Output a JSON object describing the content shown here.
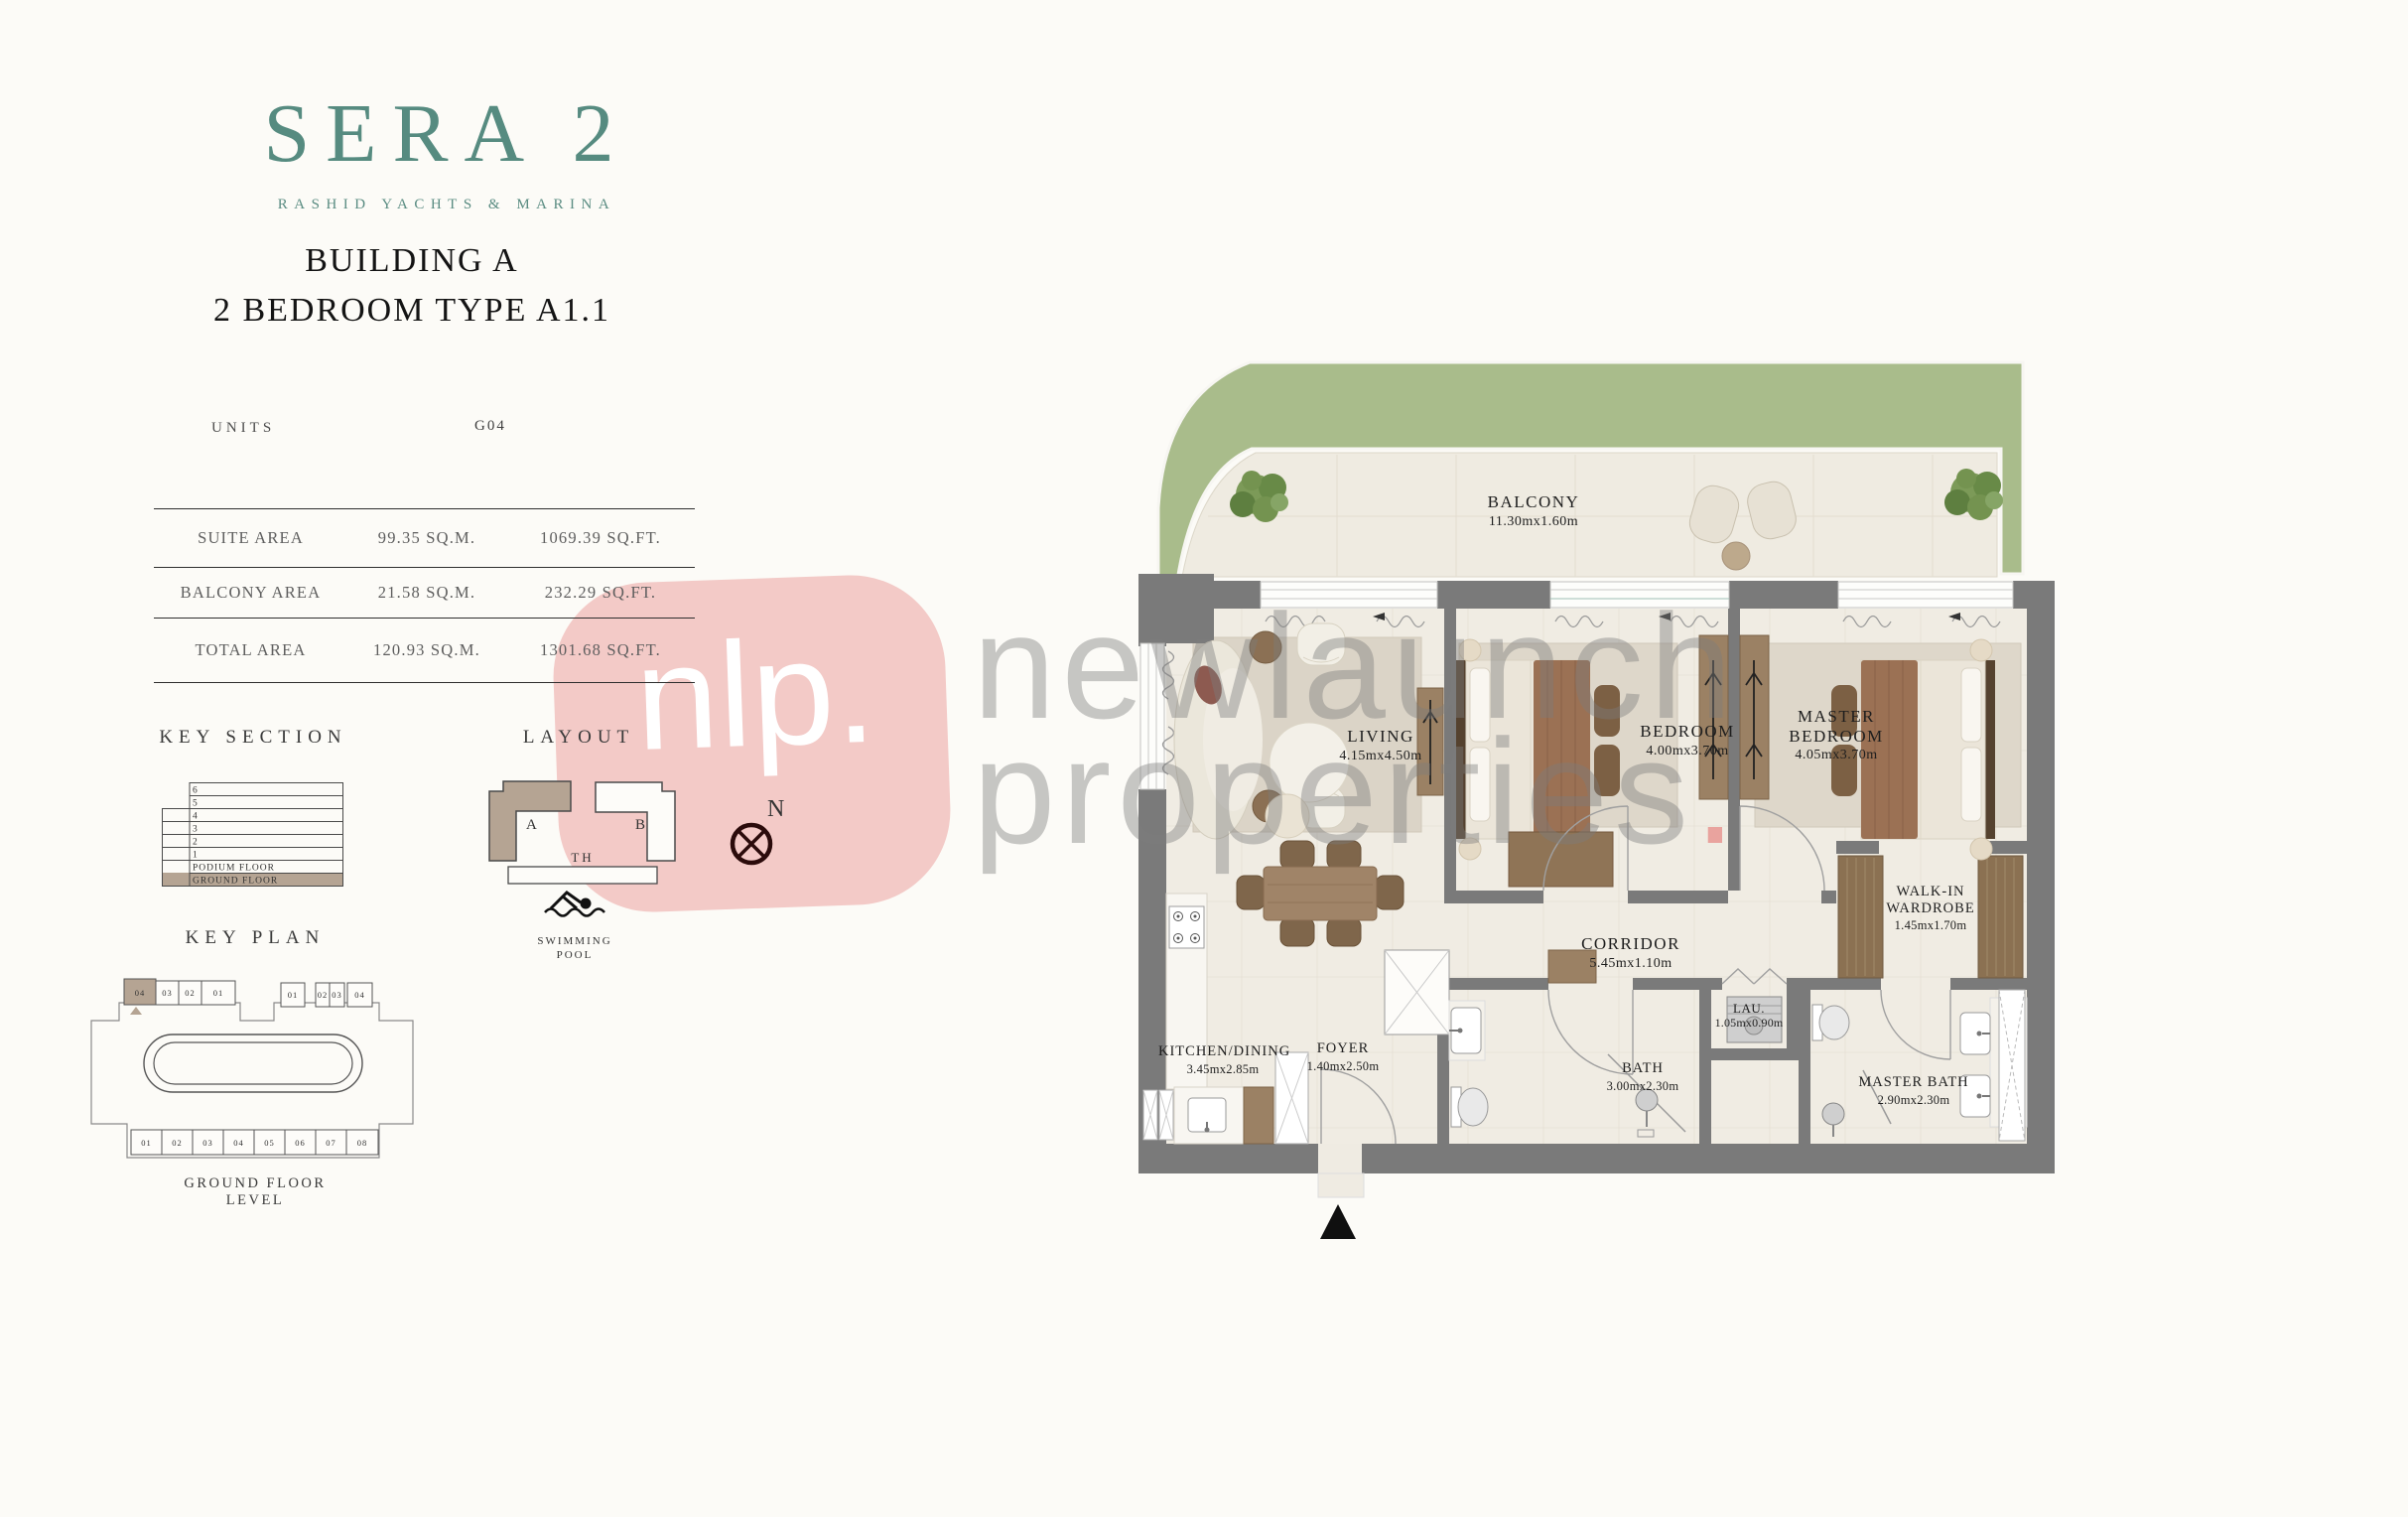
{
  "logo": {
    "title": "SERA 2",
    "subtitle": "RASHID YACHTS & MARINA"
  },
  "header": {
    "building": "BUILDING A",
    "unit_type": "2 BEDROOM TYPE A1.1"
  },
  "units": {
    "label": "UNITS",
    "value": "G04"
  },
  "area_table": {
    "rows": [
      {
        "label": "SUITE AREA",
        "sqm": "99.35 SQ.M.",
        "sqft": "1069.39 SQ.FT."
      },
      {
        "label": "BALCONY AREA",
        "sqm": "21.58 SQ.M.",
        "sqft": "232.29 SQ.FT."
      },
      {
        "label": "TOTAL AREA",
        "sqm": "120.93 SQ.M.",
        "sqft": "1301.68 SQ.FT."
      }
    ]
  },
  "key_section": {
    "title": "KEY SECTION",
    "floors": [
      "6",
      "5",
      "4",
      "3",
      "2",
      "1",
      "PODIUM FLOOR",
      "GROUND FLOOR"
    ],
    "highlighted_floor": "GROUND FLOOR"
  },
  "layout": {
    "title": "LAYOUT",
    "building_a": "A",
    "building_b": "B",
    "townhouse": "TH",
    "pool_line1": "SWIMMING",
    "pool_line2": "POOL",
    "north": "N"
  },
  "key_plan": {
    "title": "KEY PLAN",
    "caption": "GROUND FLOOR LEVEL",
    "top_left_units": [
      "04",
      "03",
      "02",
      "01"
    ],
    "top_right_units": [
      "01",
      "02",
      "03",
      "04"
    ],
    "bottom_units": [
      "01",
      "02",
      "03",
      "04",
      "05",
      "06",
      "07",
      "08"
    ],
    "highlighted_unit": "04"
  },
  "floor_plan": {
    "balcony": {
      "name": "BALCONY",
      "dims": "11.30mx1.60m"
    },
    "living": {
      "name": "LIVING",
      "dims": "4.15mx4.50m"
    },
    "bedroom": {
      "name": "BEDROOM",
      "dims": "4.00mx3.70m"
    },
    "master_bedroom": {
      "name": "MASTER BEDROOM",
      "dims": "4.05mx3.70m"
    },
    "walk_in_wardrobe": {
      "name": "WALK-IN WARDROBE",
      "dims": "1.45mx1.70m"
    },
    "corridor": {
      "name": "CORRIDOR",
      "dims": "5.45mx1.10m"
    },
    "kitchen_dining": {
      "name": "KITCHEN/DINING",
      "dims": "3.45mx2.85m"
    },
    "foyer": {
      "name": "FOYER",
      "dims": "1.40mx2.50m"
    },
    "bath": {
      "name": "BATH",
      "dims": "3.00mx2.30m"
    },
    "laundry": {
      "name": "LAU.",
      "dims": "1.05mx0.90m"
    },
    "master_bath": {
      "name": "MASTER BATH",
      "dims": "2.90mx2.30m"
    }
  },
  "watermark": {
    "logo_text": "nlp.",
    "line1": "newlaunch",
    "line2": "properties",
    "dot": "."
  },
  "colors": {
    "brand_teal": "#568b80",
    "heading": "#141414",
    "tan": "#b5a493",
    "wall_gray": "#7a7a7a",
    "landscape_green": "#a9bc8b",
    "floor_cream": "#f0ece3",
    "watermark_pink": "#f3cac7",
    "watermark_gray": "#7d7d7d",
    "accent_pink_dot": "#e99a95",
    "wood": "#8b7152"
  }
}
